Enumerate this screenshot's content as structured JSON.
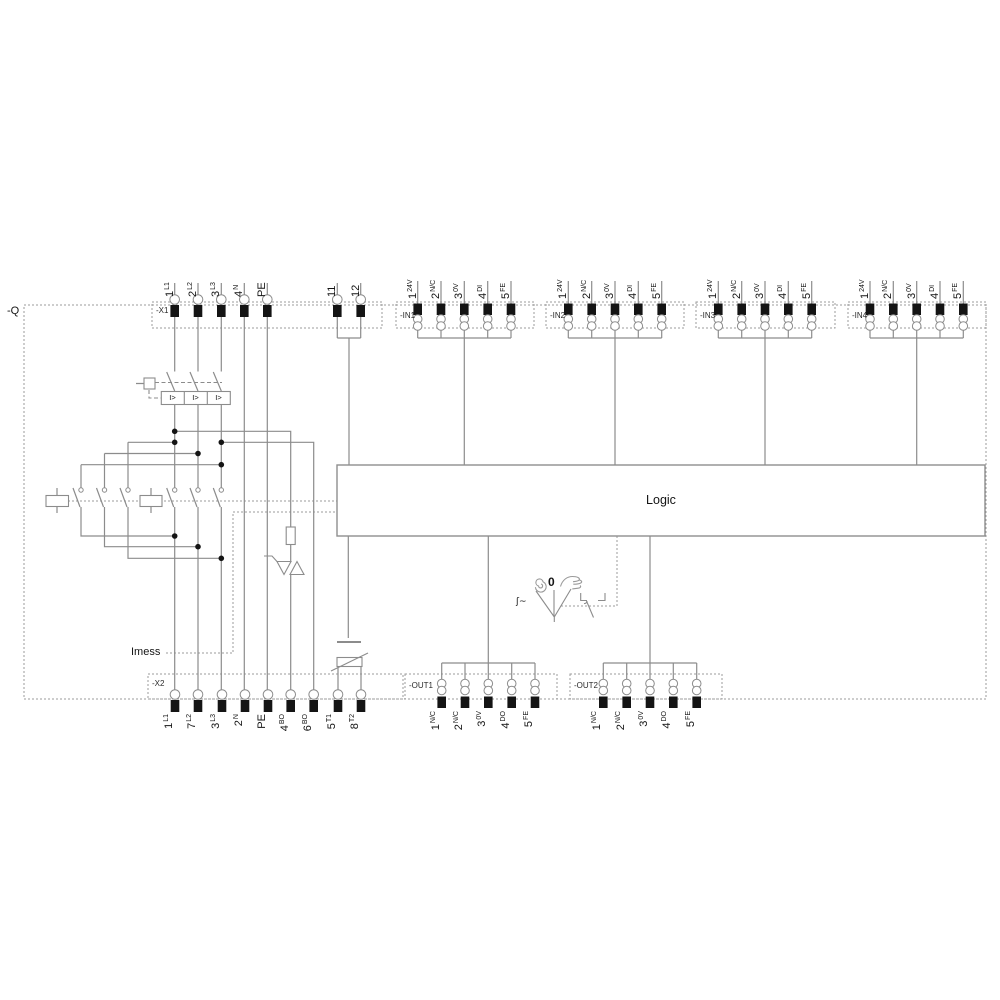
{
  "device_designation": "-Q",
  "logic": {
    "label": "Logic"
  },
  "imess": {
    "label": "Imess"
  },
  "breaker": {
    "trip_cells": [
      "I>",
      "I>",
      "I>"
    ]
  },
  "selector": {
    "zero": "0",
    "signal": "ʃ~"
  },
  "terminal_blocks": {
    "x1": {
      "label": "-X1",
      "terminals": [
        {
          "num": "1",
          "sig": "L1"
        },
        {
          "num": "2",
          "sig": "L2"
        },
        {
          "num": "3",
          "sig": "L3"
        },
        {
          "num": "4",
          "sig": "N"
        },
        {
          "num": "PE",
          "sig": ""
        }
      ],
      "aux_terminals": [
        {
          "num": "11",
          "sig": ""
        },
        {
          "num": "12",
          "sig": ""
        }
      ]
    },
    "inputs": [
      {
        "label": "-IN1",
        "terminals": [
          {
            "num": "1",
            "sig": "24V"
          },
          {
            "num": "2",
            "sig": "N/C"
          },
          {
            "num": "3",
            "sig": "0V"
          },
          {
            "num": "4",
            "sig": "DI"
          },
          {
            "num": "5",
            "sig": "FE"
          }
        ]
      },
      {
        "label": "-IN2",
        "terminals": [
          {
            "num": "1",
            "sig": "24V"
          },
          {
            "num": "2",
            "sig": "N/C"
          },
          {
            "num": "3",
            "sig": "0V"
          },
          {
            "num": "4",
            "sig": "DI"
          },
          {
            "num": "5",
            "sig": "FE"
          }
        ]
      },
      {
        "label": "-IN3",
        "terminals": [
          {
            "num": "1",
            "sig": "24V"
          },
          {
            "num": "2",
            "sig": "N/C"
          },
          {
            "num": "3",
            "sig": "0V"
          },
          {
            "num": "4",
            "sig": "DI"
          },
          {
            "num": "5",
            "sig": "FE"
          }
        ]
      },
      {
        "label": "-IN4",
        "terminals": [
          {
            "num": "1",
            "sig": "24V"
          },
          {
            "num": "2",
            "sig": "N/C"
          },
          {
            "num": "3",
            "sig": "0V"
          },
          {
            "num": "4",
            "sig": "DI"
          },
          {
            "num": "5",
            "sig": "FE"
          }
        ]
      }
    ],
    "x2": {
      "label": "-X2",
      "terminals": [
        {
          "num": "1",
          "sig": "L1"
        },
        {
          "num": "7",
          "sig": "L2"
        },
        {
          "num": "3",
          "sig": "L3"
        },
        {
          "num": "2",
          "sig": "N"
        },
        {
          "num": "PE",
          "sig": ""
        },
        {
          "num": "4",
          "sig": "BO"
        },
        {
          "num": "6",
          "sig": "BO"
        },
        {
          "num": "5",
          "sig": "T1"
        },
        {
          "num": "8",
          "sig": "T2"
        }
      ]
    },
    "outputs": [
      {
        "label": "-OUT1",
        "terminals": [
          {
            "num": "1",
            "sig": "N/C"
          },
          {
            "num": "2",
            "sig": "N/C"
          },
          {
            "num": "3",
            "sig": "0V"
          },
          {
            "num": "4",
            "sig": "DO"
          },
          {
            "num": "5",
            "sig": "FE"
          }
        ]
      },
      {
        "label": "-OUT2",
        "terminals": [
          {
            "num": "1",
            "sig": "N/C"
          },
          {
            "num": "2",
            "sig": "N/C"
          },
          {
            "num": "3",
            "sig": "0V"
          },
          {
            "num": "4",
            "sig": "DO"
          },
          {
            "num": "5",
            "sig": "FE"
          }
        ]
      }
    ]
  },
  "colors": {
    "wire": "#8c8c8c",
    "dotted": "#9b9b9b",
    "terminal_fill": "#141414",
    "text": "#141414"
  }
}
